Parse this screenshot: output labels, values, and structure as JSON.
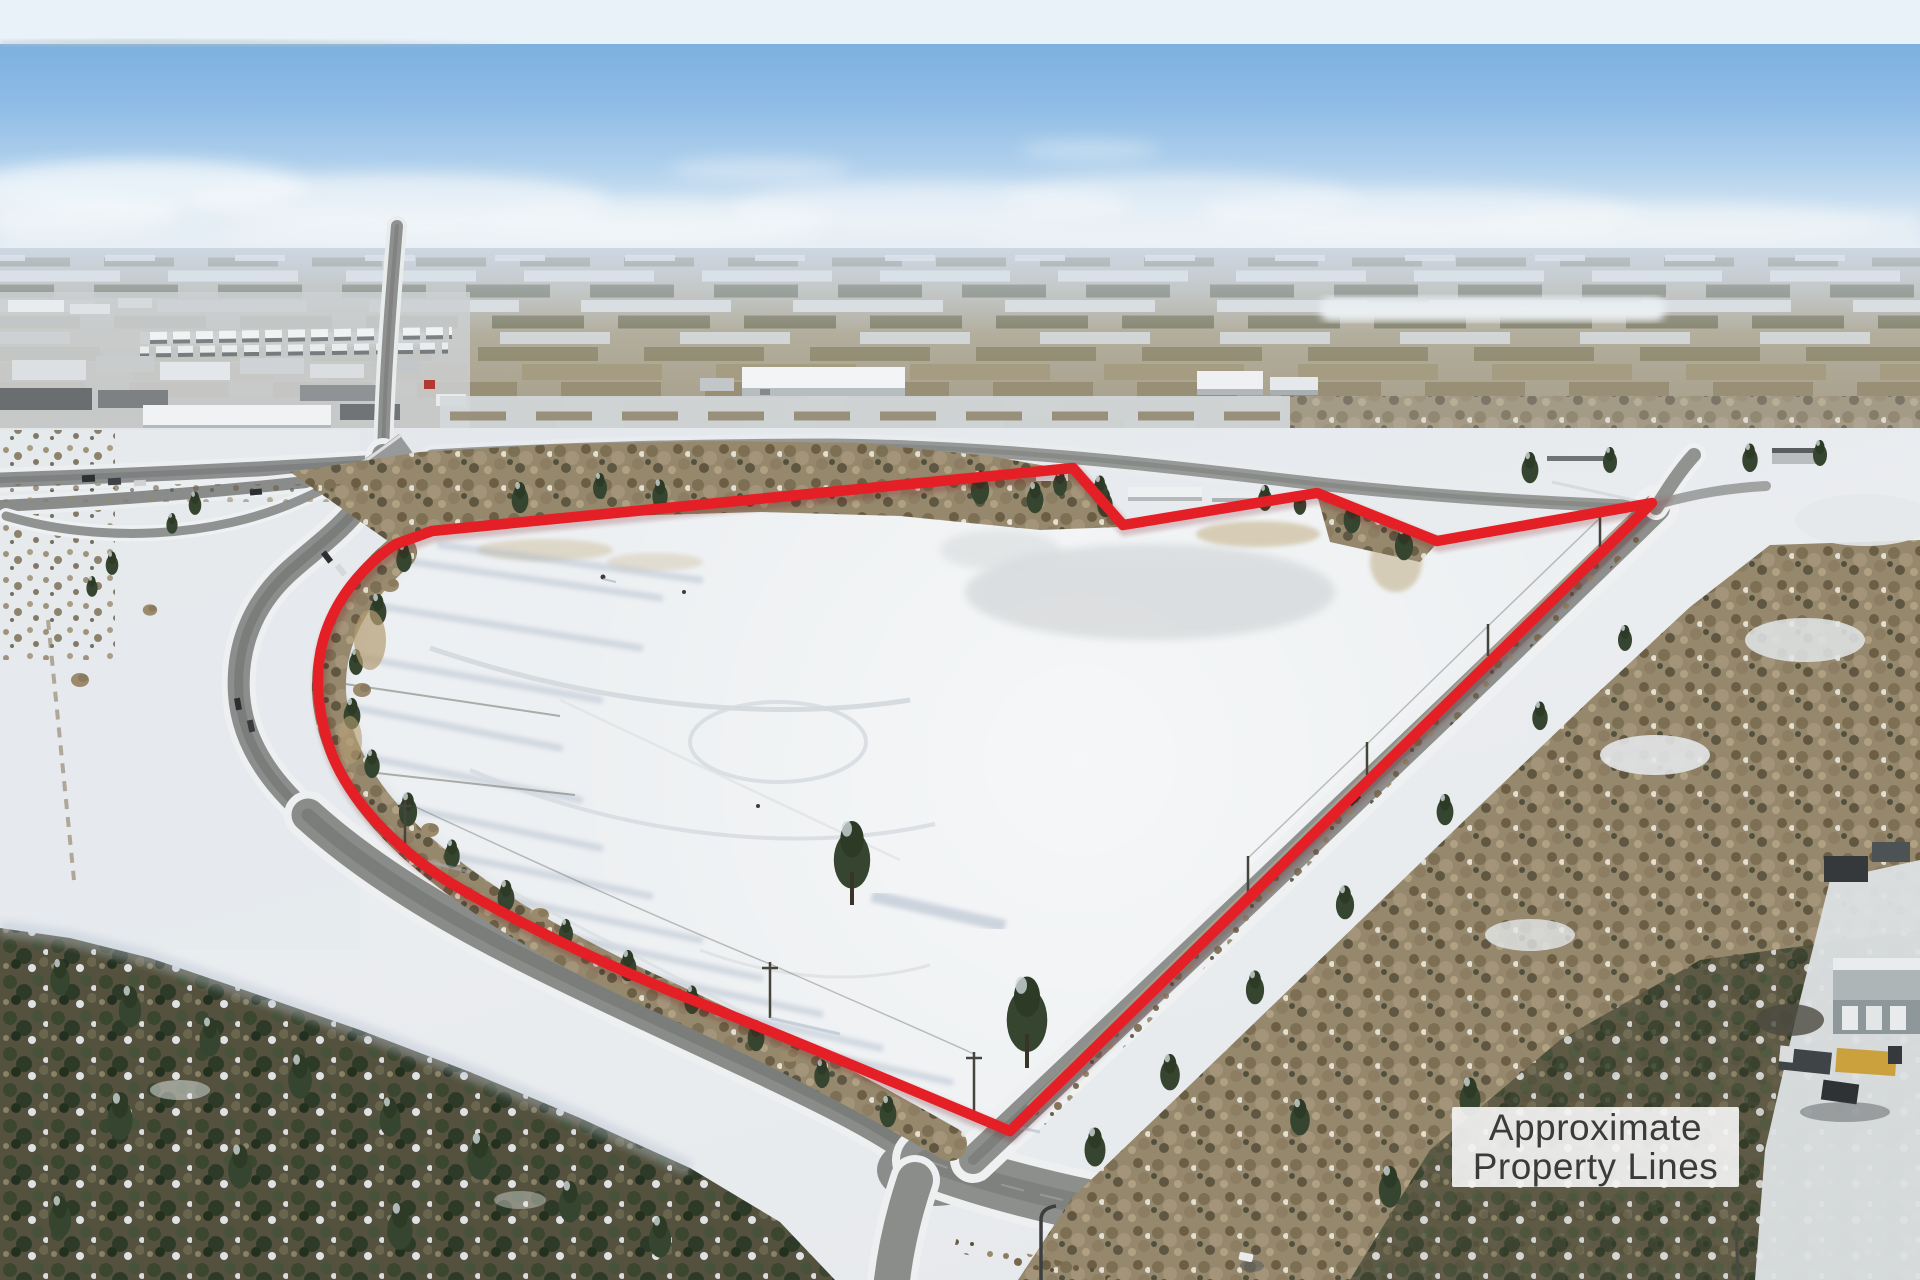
{
  "annotation": {
    "label": {
      "line1": "Approximate",
      "line2": "Property Lines"
    },
    "label_text_color": "#3b3b3b",
    "label_background": "rgba(243,243,243,0.92)",
    "line_color": "#e41f26",
    "outline_path": "M 432 531 L 1073 468 L 1123 525 L 1317 493 L 1437 541 L 1652 503 L 1010 1131 C 903 1086 793 1040 700 1003 C 610 967 521 925 449 882 C 392 846 351 800 333 757 C 317 716 314 674 323 641 C 334 601 362 566 396 544 Z"
  }
}
